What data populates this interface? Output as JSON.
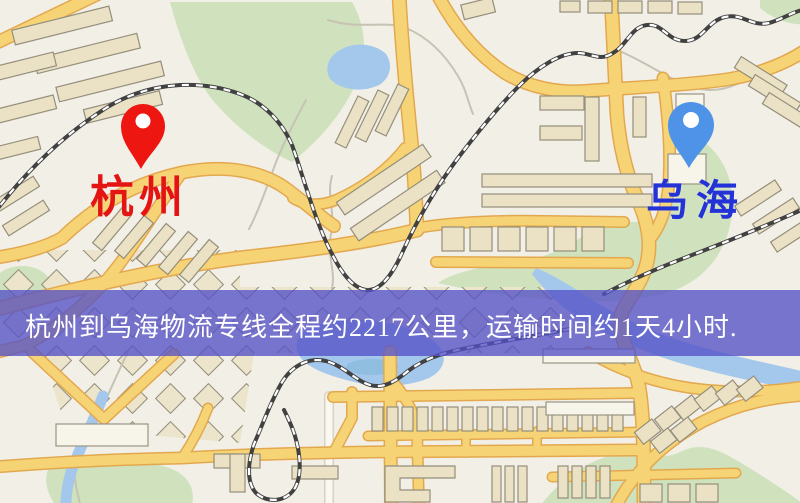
{
  "map": {
    "origin_marker": {
      "label": "杭州",
      "pin_color": "#ed1610",
      "pin_inner_color": "#ffffff",
      "label_color": "#e41412"
    },
    "destination_marker": {
      "label": "乌海",
      "pin_color": "#4f93e8",
      "pin_inner_color": "#ffffff",
      "label_color": "#2433d6"
    }
  },
  "banner": {
    "text": "杭州到乌海物流专线全程约2217公里，运输时间约1天4小时.",
    "origin": "杭州",
    "destination": "乌海",
    "distance_km": "2217",
    "duration": "1天4小时",
    "background_color": "#5451c7",
    "text_color": "#ffffff"
  },
  "palette": {
    "map_background": "#f2efe7",
    "road_fill": "#f6d476",
    "road_casing": "#e3a84e",
    "building_fill": "#ebe2c6",
    "building_stroke": "#948e7b",
    "park_green": "#cfe2bd",
    "water_blue": "#a3c8ec",
    "railway_dark": "#414141"
  }
}
